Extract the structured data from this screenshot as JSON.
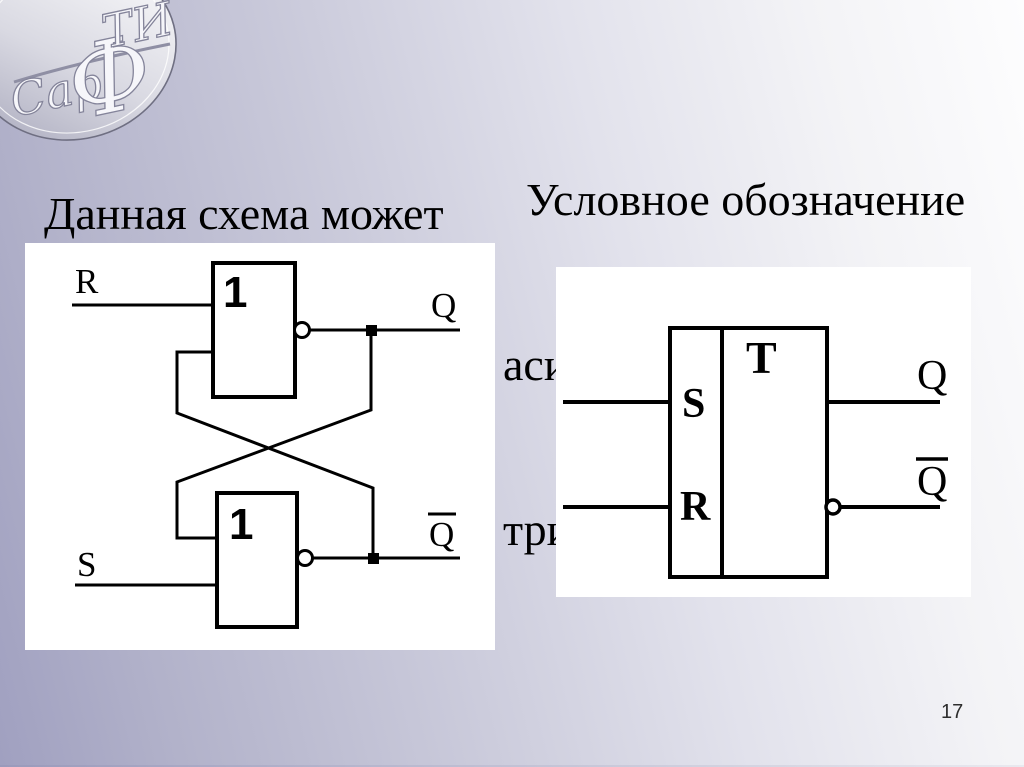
{
  "page": {
    "number": "17"
  },
  "logo": {
    "text_s": "Сар",
    "text_f": "Ф",
    "text_ti": "ТИ"
  },
  "captions": {
    "left": {
      "line1": "Данная схема может",
      "line2": "быть представлена как"
    },
    "right": {
      "line1": "  Условное обозначение",
      "line2": "асинхронного R-S",
      "line3": "триггера имеет вид"
    }
  },
  "left_diagram": {
    "gate_top_label": "1",
    "gate_bottom_label": "1",
    "input_top": "R",
    "input_bottom": "S",
    "output_top": "Q",
    "output_bottom": "Q"
  },
  "right_diagram": {
    "trigger_label": "T",
    "input_top": "S",
    "input_bottom": "R",
    "output_top": "Q",
    "output_bottom": "Q"
  },
  "colors": {
    "background_left": "#a0a0c0",
    "background_right": "#fdfdfe",
    "panel": "#ffffff",
    "line": "#000000",
    "text": "#000000"
  }
}
